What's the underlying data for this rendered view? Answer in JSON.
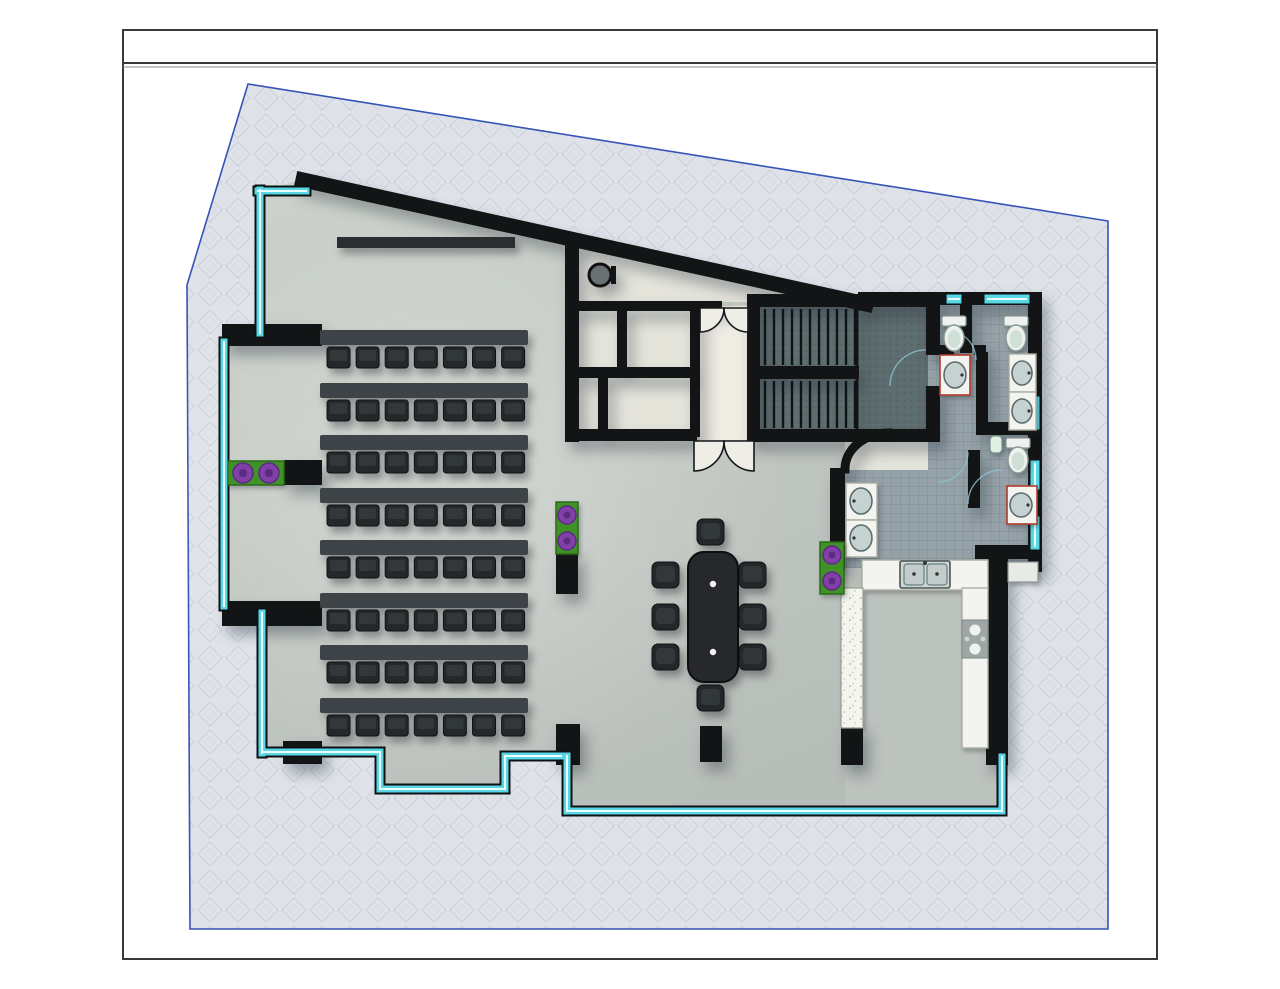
{
  "document": {
    "kind": "architectural-floor-plan",
    "view": "plan",
    "sheet_text": ""
  },
  "title_block": {
    "text": ""
  },
  "areas": {
    "training_area": {
      "label": "classroom seating",
      "desk_rows": 8,
      "seats_per_row": 7
    },
    "presentation_board": {
      "label": "whiteboard"
    },
    "meeting_area": {
      "label": "conference table",
      "seats": 8,
      "table_grommets": 2
    },
    "entrance_vestibule": {
      "label": "vestibule",
      "double_door_sets": 2
    },
    "stairwell": {
      "label": "stairs",
      "flights": 2,
      "treads_per_flight": 11
    },
    "restrooms": {
      "label": "restrooms",
      "toilets": 3,
      "urinals": 1,
      "sinks": 6
    },
    "kitchen": {
      "label": "kitchen",
      "sink_basins": 2,
      "cooktop_burners": 4,
      "bar_counters": 1
    },
    "planters": {
      "count": 3,
      "flowers_per_planter": 2
    },
    "structure": {
      "freestanding_columns": 5,
      "wall_stubs": 4,
      "round_column": 1
    }
  },
  "counts": {
    "desk_rows": 8,
    "seats_per_row": 7,
    "conference_seats": 8,
    "stair_treads_per_flight": 11,
    "toilets": 3,
    "urinals": 1,
    "restroom_sinks": 6,
    "cooktop_burners": 4,
    "planters": 3,
    "window_segments": 5
  },
  "colors": {
    "wall": "#121415",
    "glazing": "#59d7e6",
    "glazing_core": "#ecfdfe",
    "site_fill": "#dfe3e9",
    "site_outline": "#3653b8",
    "hall_floor": "#c5cbc5",
    "service_floor": "#e4e4db",
    "vestibule_floor": "#efece4",
    "stair_floor": "#5d6c6e",
    "tile_floor": "#95a2a8",
    "kitchen_floor": "#bcc2bd",
    "counter": "#f3f4f0",
    "desk": "#3e4347",
    "chair": "#25282a",
    "table": "#26282b",
    "planter_green": "#3f9326",
    "flower_purple": "#8040a8",
    "fixture_white": "#eef2ef",
    "toilet_seat_green": "#cfe0d6",
    "sink_trim_red": "#b23b2e",
    "door_swing_blue": "#8fc3d2",
    "page": "#ffffff"
  }
}
